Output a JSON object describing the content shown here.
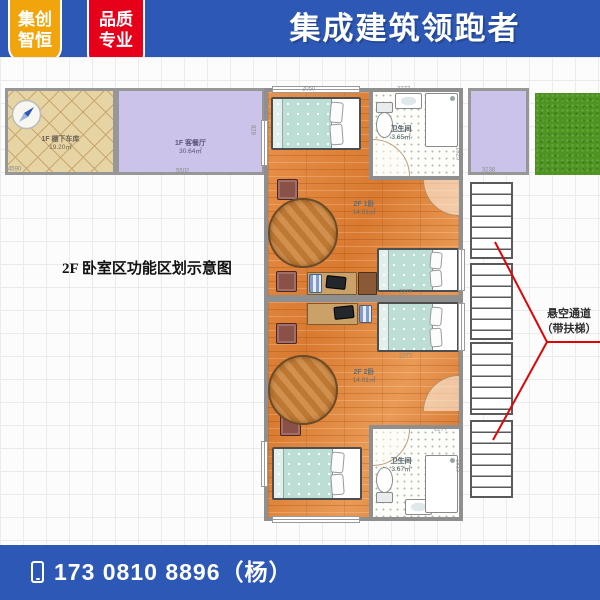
{
  "header": {
    "title": "集成建筑领跑者",
    "badge1": {
      "line1": "集创",
      "line2": "智恒"
    },
    "badge2": {
      "line1": "品质",
      "line2": "专业"
    },
    "colors": {
      "bar": "#2d58b5",
      "badge1": "#f2a40c",
      "badge2": "#e60019"
    }
  },
  "plan": {
    "caption": "2F 卧室区功能区划示意图",
    "rooms": {
      "carport": {
        "label": "1F 棚下车库",
        "area": "19.20㎡"
      },
      "living": {
        "label": "1F 客餐厅",
        "area": "30.64㎡"
      },
      "bedroom1": {
        "label": "2F 1卧",
        "area": "14.01㎡"
      },
      "bedroom2": {
        "label": "2F 2卧",
        "area": "14.01㎡"
      },
      "bath1": {
        "label": "卫生间",
        "area": "3.65㎡"
      },
      "bath2": {
        "label": "卫生间",
        "area": "3.67㎡"
      }
    },
    "annotation": {
      "line1": "悬空通道",
      "line2": "（带扶梯）"
    },
    "dims": [
      "4590",
      "5502",
      "3238",
      "828",
      "2050",
      "2277",
      "2277",
      "2277",
      "2277",
      "1825",
      "1825"
    ],
    "colors": {
      "wood": "#e0863f",
      "bedding": "#bcded4",
      "wall": "#8f8f8f",
      "purple": "#cbc3e9",
      "tile": "#e7d4a4",
      "grass": "#4e9420",
      "annotation_line": "#dd0505"
    }
  },
  "footer": {
    "phone": "173 0810 8896（杨）"
  }
}
